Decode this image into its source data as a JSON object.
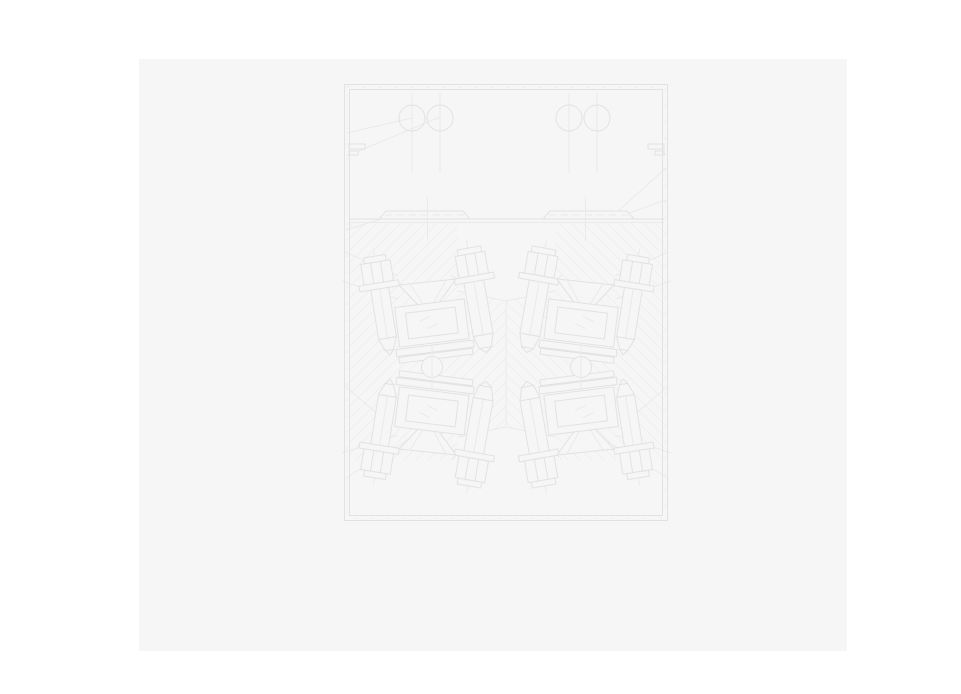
{
  "theme": {
    "page-bg": "#ffffff",
    "panel-bg": "#f5f6f5",
    "line": "#e2e2e2",
    "line-faint": "#eaeaea",
    "hatch": "#efefef"
  },
  "canvas": {
    "background": "#f5f6f5",
    "x": 139,
    "y": 59,
    "width": 708,
    "height": 592
  },
  "drawing": {
    "type": "engineering-cross-section-blueprint",
    "description": "Very faint CAD line drawing: rectangular housing with double-line border; upper chamber with two pairs of circular ports on vertical centerlines and stepped wall notches; a horizontal divider carrying two chamfered mounting rails with dashed centerlines; lower chamber cross-hatched, containing four mirror-symmetric stud-bolt groups (hex nuts, washers, threaded shafts with pointed tips), funnel ports, hatched seat blocks with shim stacks, and two shaft circles on the horizontal mirror axis; assorted leader lines run from the frame walls to parts.",
    "visible_text": "none",
    "frame": {
      "x": 344,
      "y": 84,
      "width": 324,
      "height": 437,
      "border": "double-with-tick-marks"
    },
    "upper_chamber_ports": [
      {
        "cx": 412,
        "cy": 118,
        "r": 13
      },
      {
        "cx": 440,
        "cy": 118,
        "r": 13
      },
      {
        "cx": 569,
        "cy": 118,
        "r": 13
      },
      {
        "cx": 597,
        "cy": 118,
        "r": 13
      }
    ],
    "divider_y": 219,
    "rails": [
      {
        "x1": 379,
        "x2": 470,
        "y": 219
      },
      {
        "x1": 543,
        "x2": 634,
        "y": 219
      }
    ],
    "bolt_groups": 4,
    "studs_per_group": 2,
    "shaft_circles": [
      {
        "cx": 432,
        "cy": 367,
        "r": 10.5
      },
      {
        "cx": 581,
        "cy": 367,
        "r": 10.5
      }
    ],
    "hatch": {
      "region_y1": 223,
      "region_y2": 460,
      "left_direction": "/",
      "right_direction": "\\",
      "mirror_axis_x": 506.5
    }
  }
}
